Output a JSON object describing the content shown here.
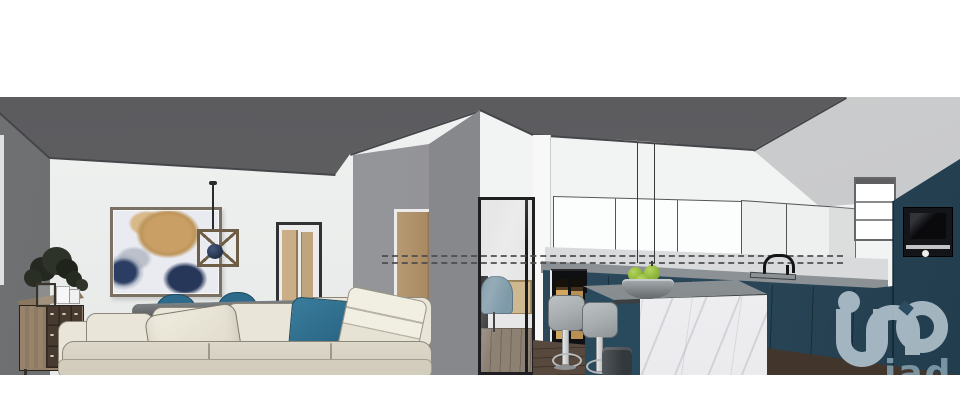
{
  "meta": {
    "type": "3d-interior-rendering",
    "style": "sketchup-style architectural visualization",
    "rooms": [
      "living-dining-room",
      "kitchen"
    ],
    "canvas": {
      "width": 960,
      "height": 415,
      "content_top": 97,
      "content_bottom": 375
    }
  },
  "watermark": {
    "brand": "iad",
    "glyph": "iad-house-monogram",
    "text": "iad",
    "glyph_color": "#a9bcc6",
    "text_color": "#7d98a6"
  },
  "palette": {
    "page_bg": "#ffffff",
    "ceiling": "#616164",
    "right_wall": "#c6c7c8",
    "left_wall": "#6f7072",
    "wall": "#edefee",
    "pillar": "#8f9094",
    "divider": "#85878a",
    "wood_door": "#b3966f",
    "dresser_wood": "#93806a",
    "dresser_drawers": "#473b2f",
    "art_tan": "#c99f66",
    "art_navy": "#26375a",
    "art_bg": "#e9ebf1",
    "sofa": "#e9e5d8",
    "sofa_shade": "#cfc9b9",
    "outline": "#8d8879",
    "teal_textile": "#2e6b8a",
    "cabinet_teal": "#2d4d62",
    "cabinet_teal_dark": "#223d4d",
    "counter": "#9aa0a3",
    "backsplash": "#d9dadb",
    "marble": "#f4f4f6",
    "floor": "#57493d",
    "floor_dark": "#42362c",
    "wine_glow": "#d3a660",
    "appliance": "#141518",
    "apple": "#8fb63c",
    "stool": "#a9aeb1",
    "office_chair": "#7e99a8",
    "office_wood": "#cdb88f",
    "glass_frame": "#1f1f22",
    "wm": "#a9bcc6",
    "wm_text": "#7d98a6"
  },
  "scene": {
    "living_room": {
      "objects": [
        "abstract wall art (tan and navy)",
        "wood cage pendant light",
        "open doorway to hallway",
        "light wood interior door",
        "wood sideboard with dark drawers",
        "potted plants and photo frames",
        "cream fabric sofa with teal pillow and throw blanket",
        "dark gray dining table",
        "two teal dining chairs"
      ]
    },
    "kitchen": {
      "objects": [
        "glass partition to office nook (desk chair, wood credenza)",
        "white handleless upper cabinets",
        "open white shelving unit",
        "petrol-teal base cabinets",
        "tall teal column with built-in microwave oven",
        "gray countertop with black gooseneck faucet",
        "built-in wine cabinet with lit bottles",
        "marble waterfall island",
        "bowl of green apples",
        "two gray bar stools",
        "dark wood plank floor",
        "two dashed layout guide lines on backsplash"
      ]
    }
  }
}
